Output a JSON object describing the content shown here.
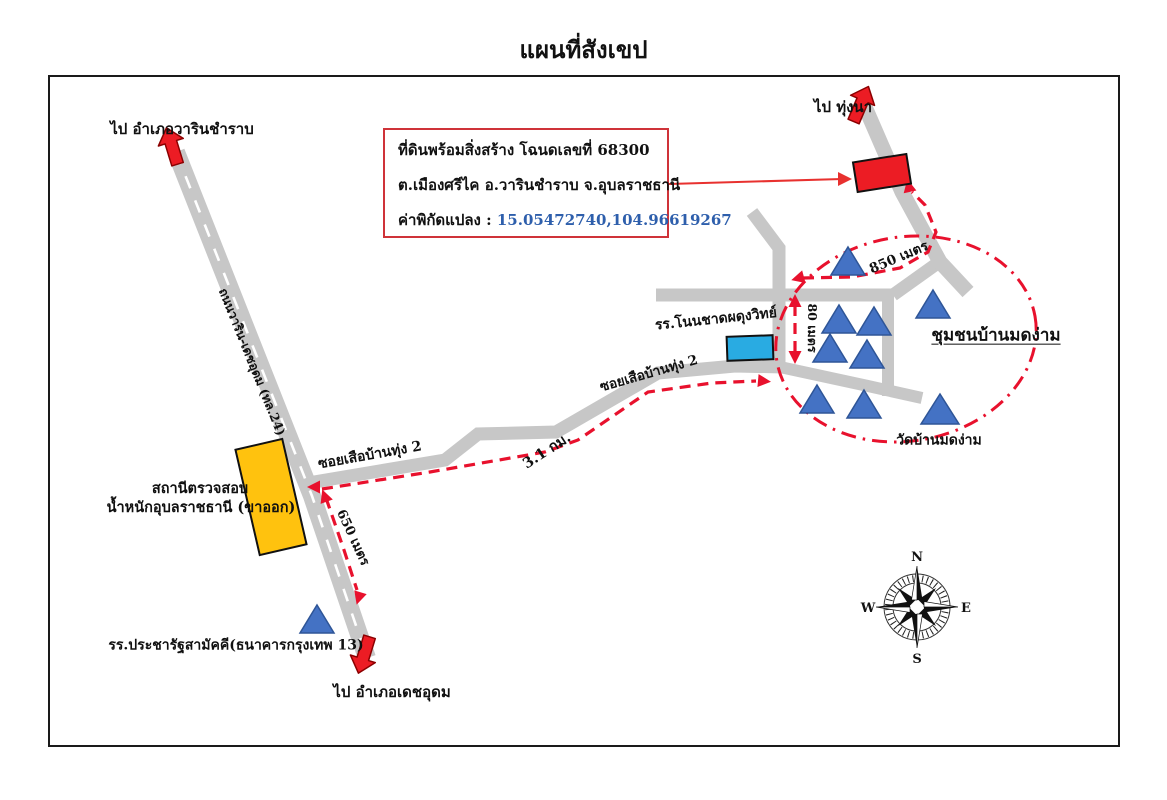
{
  "page": {
    "title": "แผนที่สังเขป"
  },
  "info_box": {
    "line1": "ที่ดินพร้อมสิ่งสร้าง โฉนดเลขที่ 68300",
    "line2": "ต.เมืองศรีไค อ.วารินชำราบ จ.อุบลราชธานี",
    "line3_label": "ค่าพิกัดแปลง : ",
    "coordinates": "15.05472740,104.96619267"
  },
  "labels": {
    "to_warin": "ไป อำเภอวารินชำราบ",
    "to_fields": "ไป ทุ่งนา",
    "to_det_udom": "ไป อำเภอเดชอุดม",
    "highway_name": "ถนนวาริน-เดชอุดม (ทล.24)",
    "soi_main": "ซอยเสือบ้านทุ่ง 2",
    "soi_main_2": "ซอยเสือบ้านทุ่ง 2",
    "dist_31km": "3.1 กม.",
    "dist_650m": "650 เมตร",
    "dist_850m": "850 เมตร",
    "dist_80m": "80 เมตร",
    "school_nonchat": "รร.โนนชาดผดุงวิทย์",
    "school_pracharat": "รร.ประชารัฐสามัคคี(ธนาคารกรุงเทพ 13)",
    "station_line1": "สถานีตรวจสอบ",
    "station_line2": "น้ำหนักอุบลราชธานี (ขาออก)",
    "community": "ชุมชนบ้านมดง่าม",
    "temple": "วัดบ้านมดง่าม"
  },
  "compass": {
    "n": "N",
    "s": "S",
    "e": "E",
    "w": "W"
  },
  "colors": {
    "road_gray": "#c7c7c7",
    "route_red": "#e8112d",
    "parcel_red": "#ec1c24",
    "school_cyan": "#29abe2",
    "station_orange": "#ffc20e",
    "house_blue": "#4472c4",
    "coordinate_blue": "#2e5fac"
  }
}
